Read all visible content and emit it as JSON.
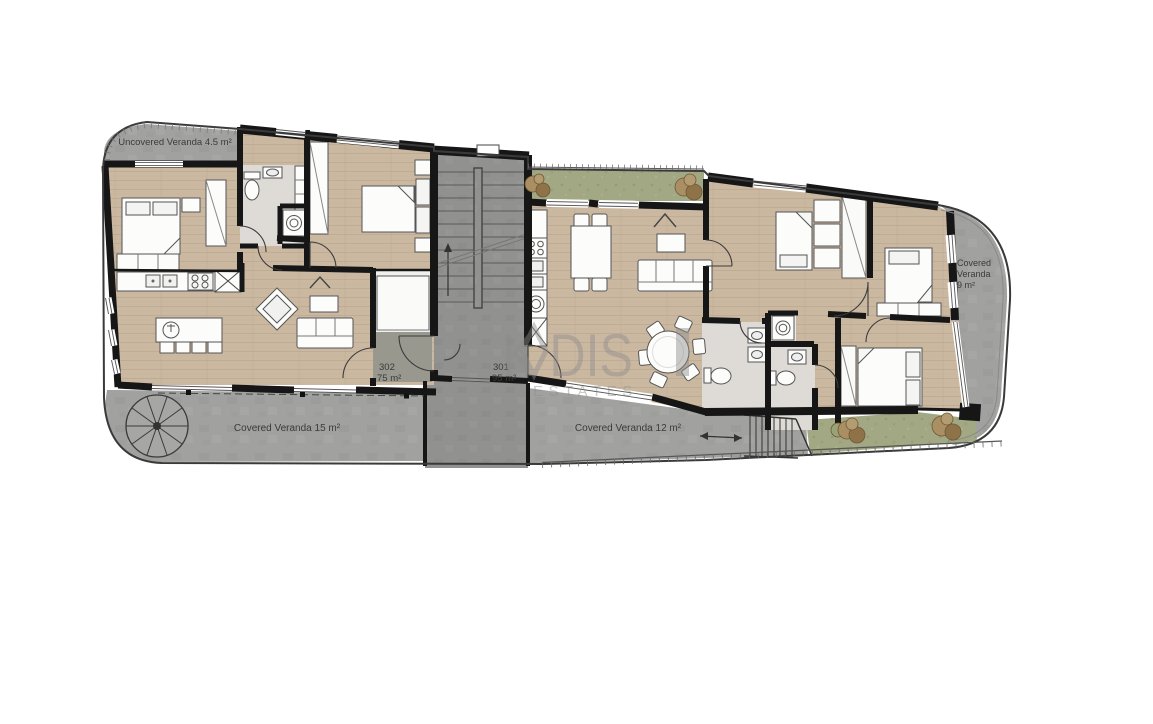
{
  "plan": {
    "units": [
      {
        "id": "302",
        "area": "75 m²"
      },
      {
        "id": "301",
        "area": "95 m²"
      }
    ],
    "verandas": [
      {
        "label": "Uncovered Veranda 4.5 m²"
      },
      {
        "label": "Covered Veranda 15 m²"
      },
      {
        "label": "Covered Veranda 12 m²"
      },
      {
        "lines": [
          "Covered",
          "Veranda",
          "9 m²"
        ]
      }
    ],
    "watermark": {
      "text": "K DIS",
      "sub": "ESTATES"
    },
    "colors": {
      "wall": "#161616",
      "wood": "#cbb8a1",
      "concrete": "#a1a19f",
      "stair_core": "#91918f",
      "green": "#a2a883",
      "label_text": "#3b3b3b",
      "watermark": "#8c8c8c"
    }
  }
}
